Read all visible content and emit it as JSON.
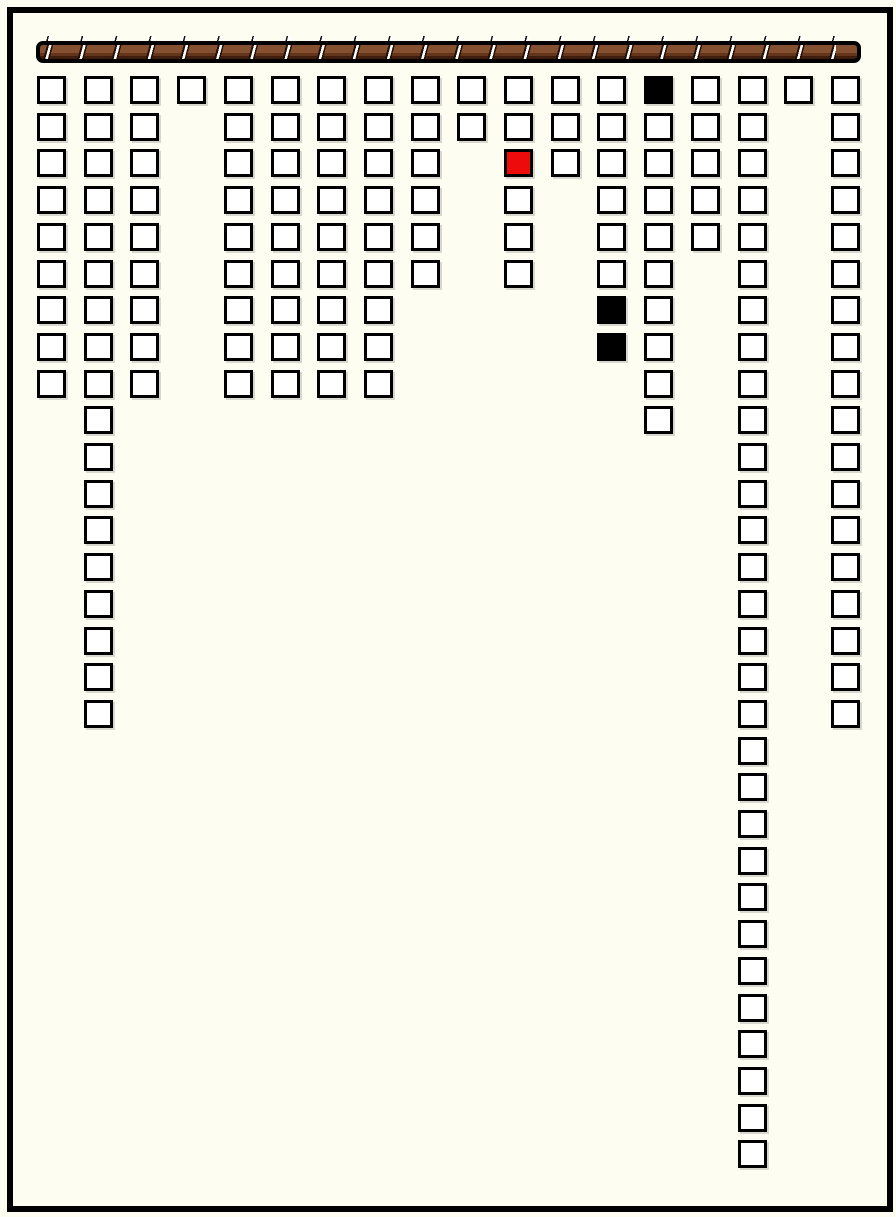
{
  "colors": {
    "page_background": "#fdfdf1",
    "frame": "#000000",
    "cell_fill": "#ffffff",
    "cell_border": "#000000",
    "special_black": "#000000",
    "special_red": "#ee0b0b",
    "rod_brown": "#84502f",
    "rod_brown_dark": "#3f1d0c",
    "rod_separator": "#ffffff"
  },
  "rod": {
    "segments": 25
  },
  "board": {
    "column_count": 18,
    "total_cells": 162,
    "columns": [
      {
        "col": 0,
        "cell_count": 9,
        "special_cells": []
      },
      {
        "col": 1,
        "cell_count": 18,
        "special_cells": []
      },
      {
        "col": 2,
        "cell_count": 9,
        "special_cells": []
      },
      {
        "col": 3,
        "cell_count": 1,
        "special_cells": []
      },
      {
        "col": 4,
        "cell_count": 9,
        "special_cells": []
      },
      {
        "col": 5,
        "cell_count": 9,
        "special_cells": []
      },
      {
        "col": 6,
        "cell_count": 9,
        "special_cells": []
      },
      {
        "col": 7,
        "cell_count": 9,
        "special_cells": []
      },
      {
        "col": 8,
        "cell_count": 6,
        "special_cells": []
      },
      {
        "col": 9,
        "cell_count": 2,
        "special_cells": []
      },
      {
        "col": 10,
        "cell_count": 6,
        "special_cells": [
          {
            "row": 2,
            "color": "red"
          }
        ]
      },
      {
        "col": 11,
        "cell_count": 3,
        "special_cells": []
      },
      {
        "col": 12,
        "cell_count": 8,
        "special_cells": [
          {
            "row": 6,
            "color": "black"
          },
          {
            "row": 7,
            "color": "black"
          }
        ]
      },
      {
        "col": 13,
        "cell_count": 10,
        "special_cells": [
          {
            "row": 0,
            "color": "black"
          }
        ]
      },
      {
        "col": 14,
        "cell_count": 5,
        "special_cells": []
      },
      {
        "col": 15,
        "cell_count": 30,
        "special_cells": []
      },
      {
        "col": 16,
        "cell_count": 1,
        "special_cells": []
      },
      {
        "col": 17,
        "cell_count": 18,
        "special_cells": []
      }
    ]
  }
}
